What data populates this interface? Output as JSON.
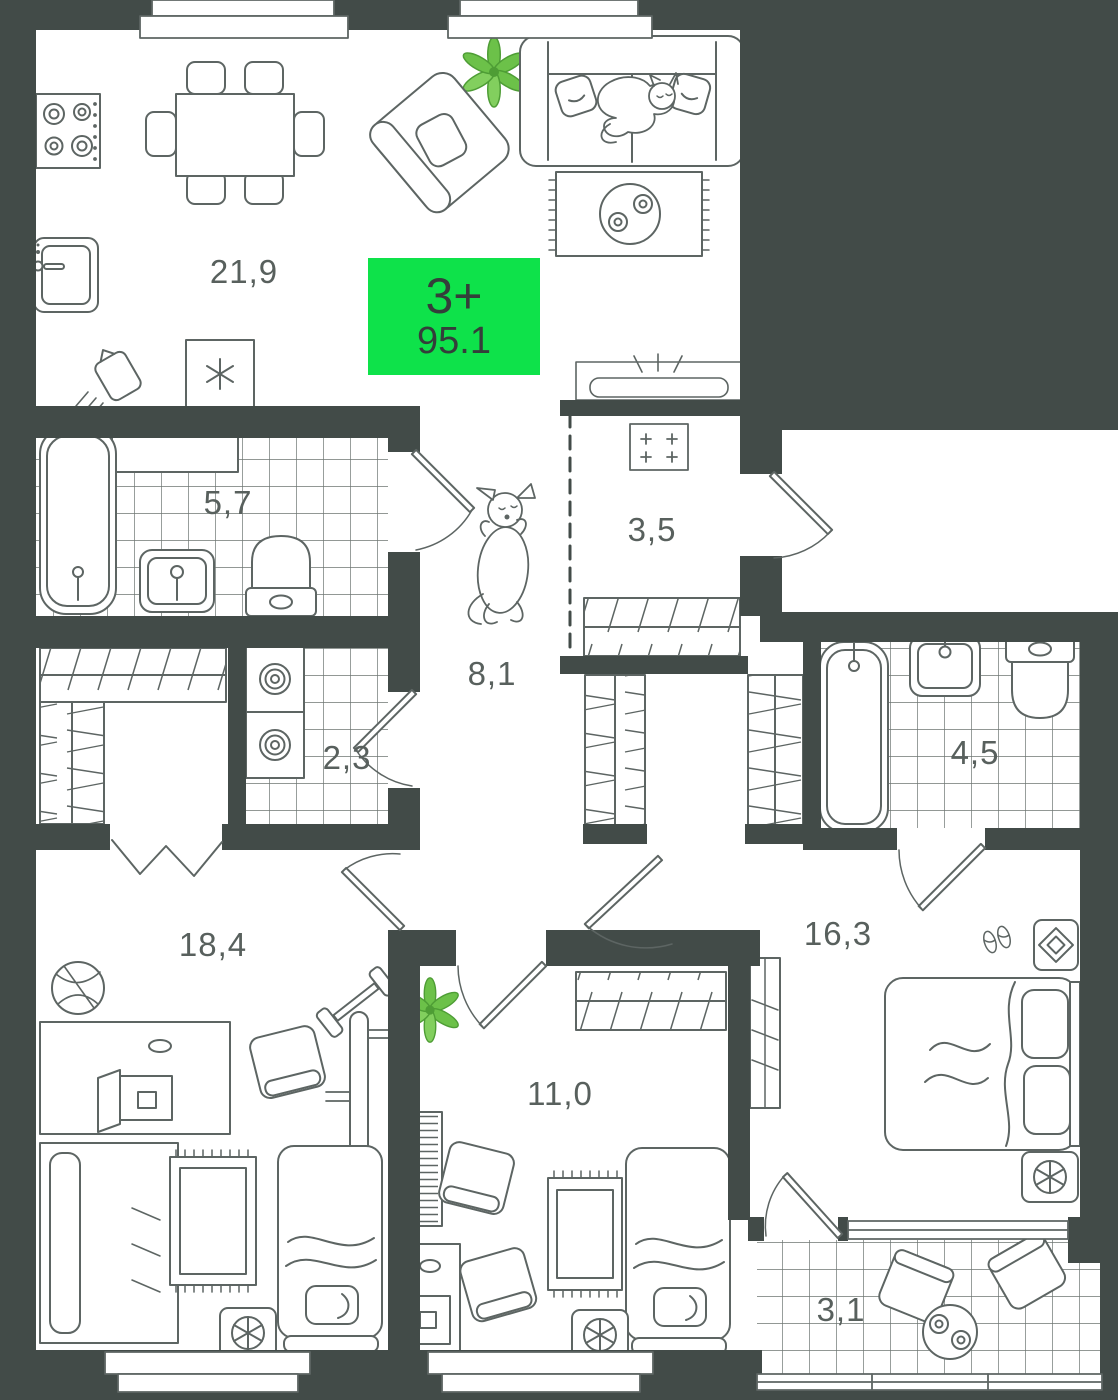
{
  "plan_badge": {
    "type_label": "3+",
    "area_label": "95.1"
  },
  "rooms": [
    {
      "name": "kitchen-living-room",
      "area_label": "21,9"
    },
    {
      "name": "bathroom-main",
      "area_label": "5,7"
    },
    {
      "name": "storage-laundry",
      "area_label": "2,3"
    },
    {
      "name": "hallway",
      "area_label": "8,1"
    },
    {
      "name": "entry-hall",
      "area_label": "3,5"
    },
    {
      "name": "bathroom-second",
      "area_label": "4,5"
    },
    {
      "name": "bedroom-first",
      "area_label": "18,4"
    },
    {
      "name": "bedroom-second",
      "area_label": "11,0"
    },
    {
      "name": "master-bedroom",
      "area_label": "16,3"
    },
    {
      "name": "balcony",
      "area_label": "3,1"
    }
  ],
  "colors": {
    "badge_green": "#0EE24A",
    "badge_text": "#343E3A",
    "wall": "#424B48",
    "furniture_line": "#5D6563",
    "tile_line": "#6D7572",
    "label_text": "#58605D",
    "plant_green": "#6CC149",
    "plant_green_dark": "#4E9D35"
  }
}
